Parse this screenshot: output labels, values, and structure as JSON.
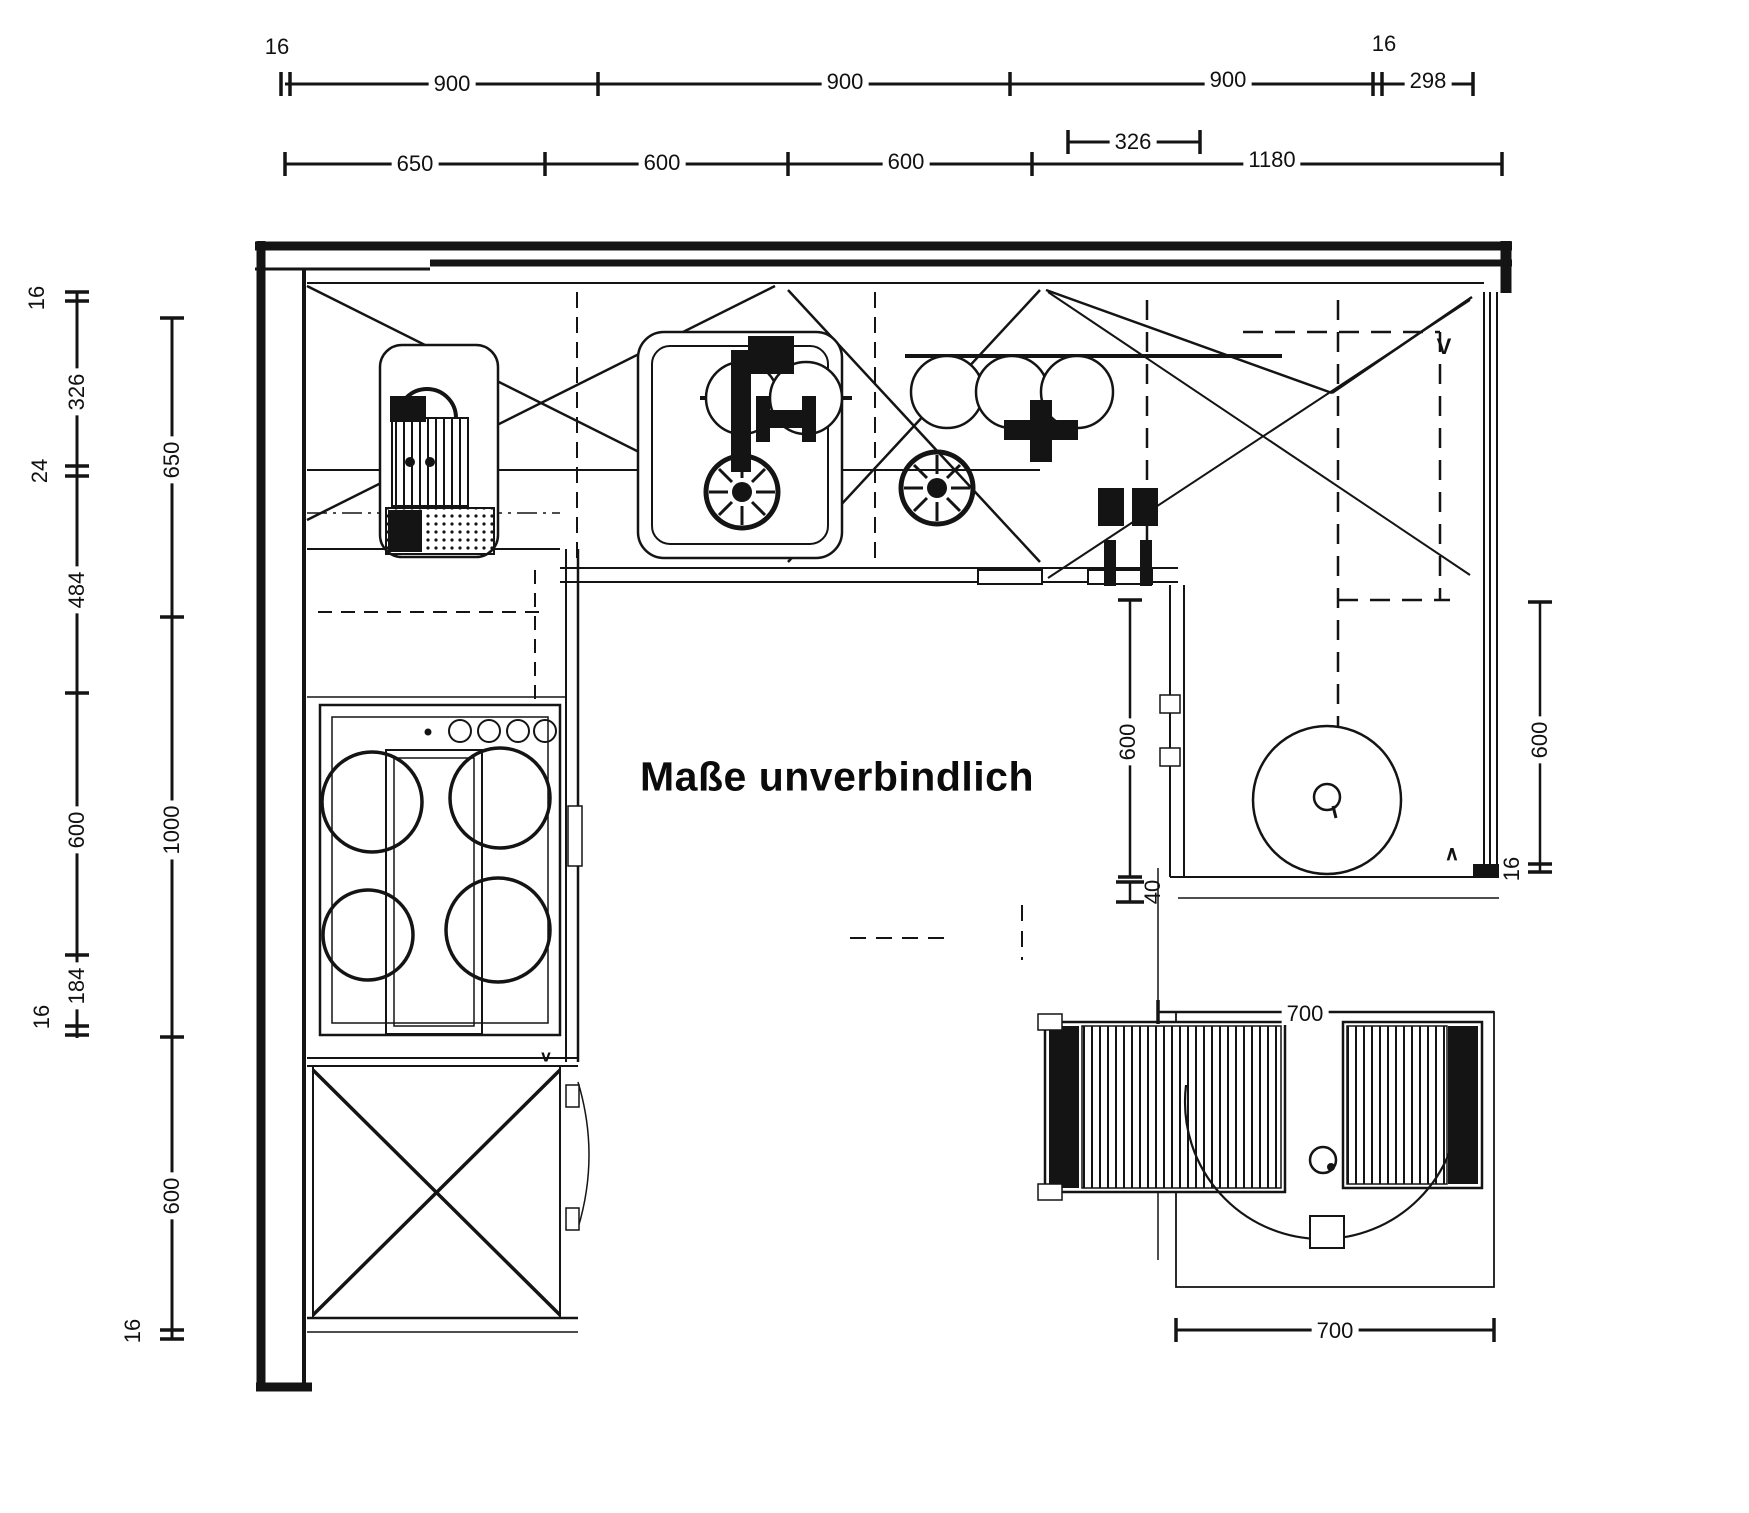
{
  "watermark": "Maße unverbindlich",
  "dims": {
    "top_row1": [
      "16",
      "900",
      "900",
      "900",
      "16",
      "298"
    ],
    "top_row2": [
      "650",
      "600",
      "600",
      "1180"
    ],
    "top_row2_sub": "326",
    "left_inner": [
      "16",
      "326",
      "24",
      "484",
      "600",
      "184",
      "16"
    ],
    "left_outer": [
      "650",
      "1000",
      "600",
      "16"
    ],
    "right_inner": [
      "600",
      "40"
    ],
    "right_outer": [
      "600",
      "16"
    ],
    "table_top": "700",
    "table_bottom": "700"
  },
  "marks": {
    "door_left": "v",
    "door_right": "∧",
    "corner_cabinet": "V"
  },
  "colors": {
    "ink": "#111111",
    "paper": "#ffffff"
  }
}
